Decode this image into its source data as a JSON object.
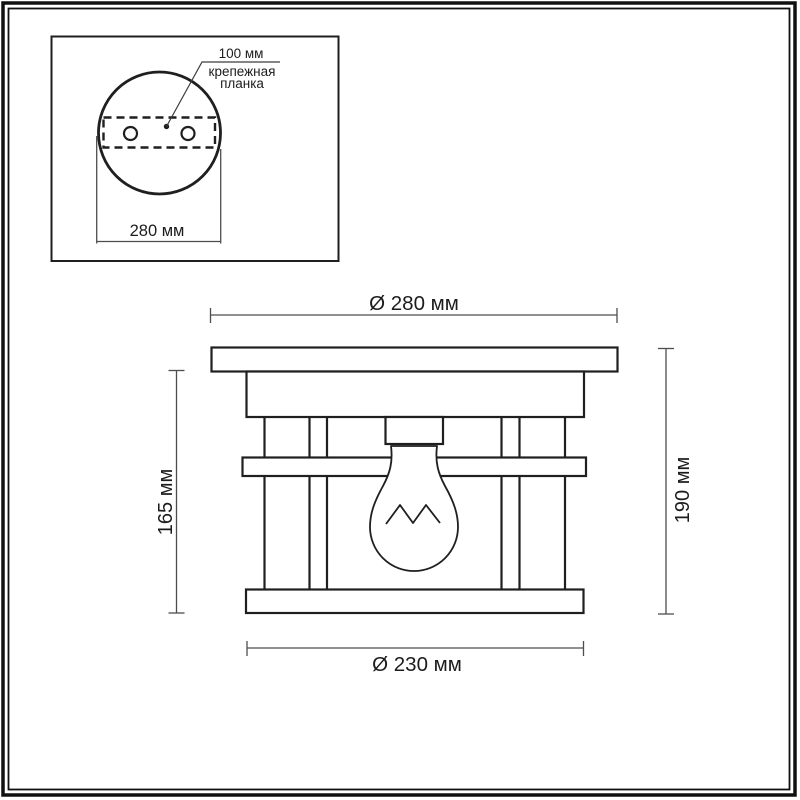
{
  "colors": {
    "object_line": "#1f1f1f",
    "dimension_line": "#4d4d4d",
    "background": "#ffffff",
    "frame": "#101010"
  },
  "inset_panel": {
    "hole_spacing_label": "100 мм",
    "bracket_label_line1": "крепежная",
    "bracket_label_line2": "планка",
    "plate_width_label": "280 мм"
  },
  "front_view": {
    "top_diameter_label": "Ø 280 мм",
    "inner_height_label": "165 мм",
    "overall_height_label": "190 мм",
    "bottom_diameter_label": "Ø 230 мм"
  }
}
